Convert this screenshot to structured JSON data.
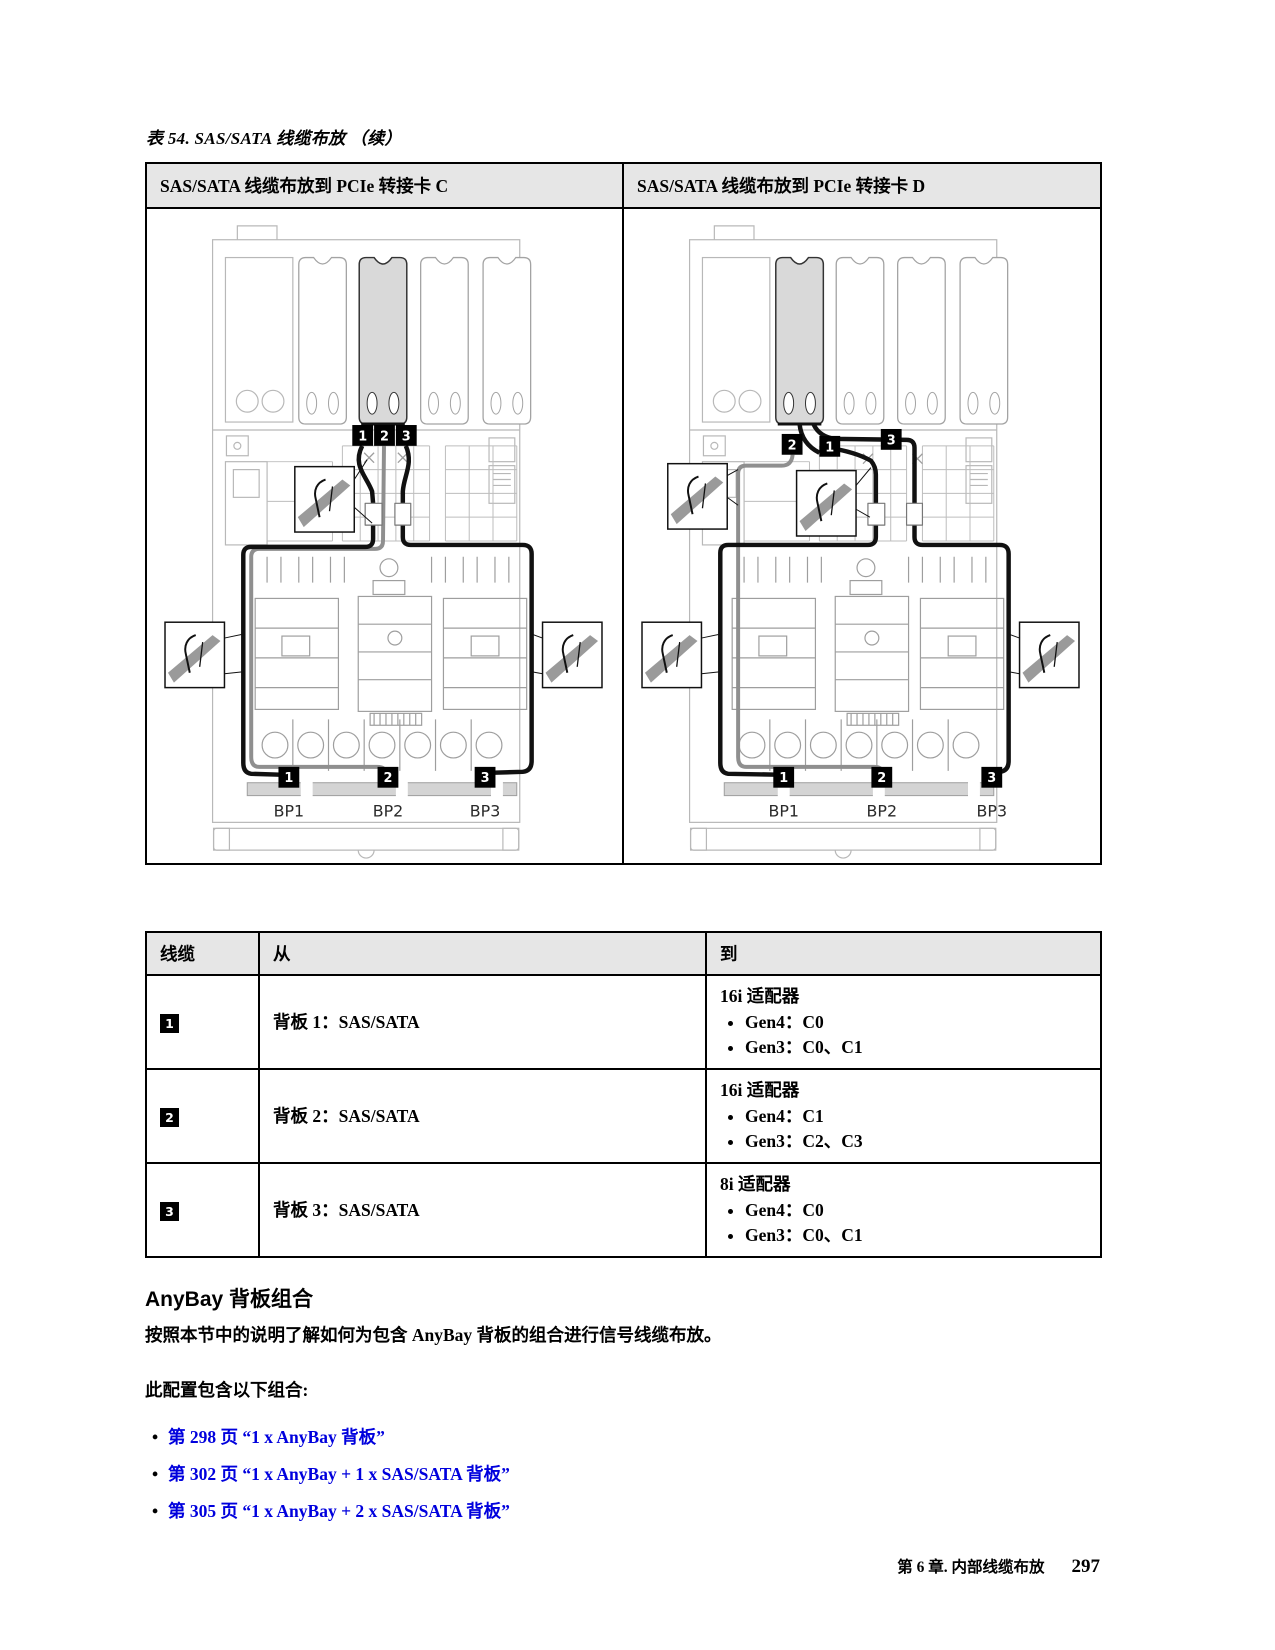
{
  "page": {
    "caption": "表 54. SAS/SATA 线缆布放 （续）",
    "footer": {
      "chapter": "第 6 章. 内部线缆布放",
      "page_number": "297"
    }
  },
  "routing_table": {
    "headers": [
      "SAS/SATA 线缆布放到 PCIe 转接卡 C",
      "SAS/SATA 线缆布放到 PCIe 转接卡 D"
    ],
    "diagram_c": {
      "top_badges": [
        "1",
        "2",
        "3"
      ],
      "bottom_badges": [
        "1",
        "2",
        "3"
      ],
      "bp_labels": [
        "BP1",
        "BP2",
        "BP3"
      ]
    },
    "diagram_d": {
      "top_badges": [
        "2",
        "1",
        "3"
      ],
      "bottom_badges": [
        "1",
        "2",
        "3"
      ],
      "bp_labels": [
        "BP1",
        "BP2",
        "BP3"
      ]
    }
  },
  "cable_table": {
    "headers": [
      "线缆",
      "从",
      "到"
    ],
    "rows": [
      {
        "badge": "1",
        "from": "背板 1：SAS/SATA",
        "to_title": "16i 适配器",
        "to_items": [
          "Gen4：C0",
          "Gen3：C0、C1"
        ]
      },
      {
        "badge": "2",
        "from": "背板 2：SAS/SATA",
        "to_title": "16i 适配器",
        "to_items": [
          "Gen4：C1",
          "Gen3：C2、C3"
        ]
      },
      {
        "badge": "3",
        "from": "背板 3：SAS/SATA",
        "to_title": "8i 适配器",
        "to_items": [
          "Gen4：C0",
          "Gen3：C0、C1"
        ]
      }
    ]
  },
  "anybay_section": {
    "heading": "AnyBay 背板组合",
    "intro": "按照本节中的说明了解如何为包含 AnyBay 背板的组合进行信号线缆布放。",
    "config_line": "此配置包含以下组合:",
    "links": [
      "第 298 页 “1 x AnyBay 背板”",
      "第 302 页 “1 x AnyBay + 1 x SAS/SATA 背板”",
      "第 305 页 “1 x AnyBay + 2 x SAS/SATA 背板”"
    ]
  }
}
